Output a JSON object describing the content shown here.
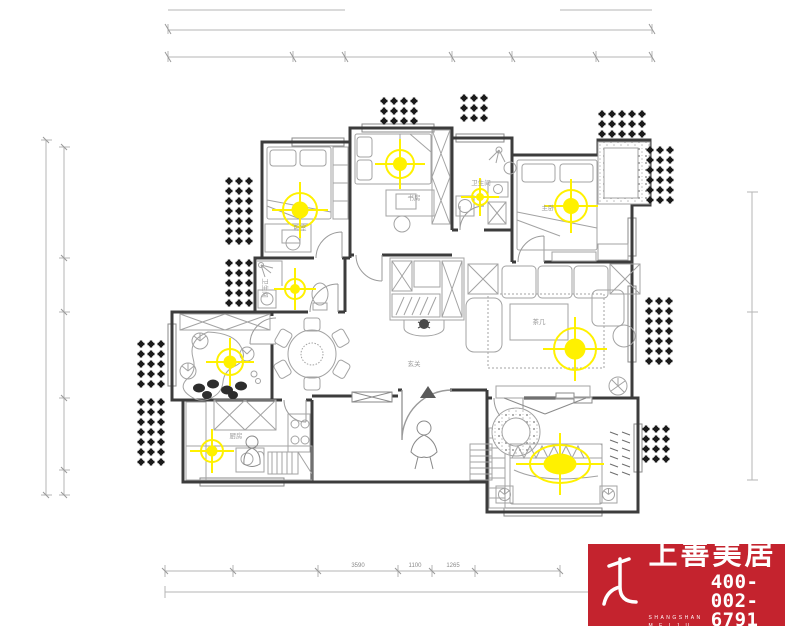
{
  "plan": {
    "wall_color": "#3c3c3c",
    "furniture_color": "#a3a3a3",
    "light_color": "#fff100",
    "plant_color": "#1b1b1b",
    "dimension_color": "#b5b5b5",
    "labels": [
      {
        "text": "卧室",
        "x": 300,
        "y": 230
      },
      {
        "text": "书房",
        "x": 414,
        "y": 200
      },
      {
        "text": "卫生间",
        "x": 481,
        "y": 185
      },
      {
        "text": "主卧",
        "x": 548,
        "y": 210
      },
      {
        "text": "玄关",
        "x": 414,
        "y": 366
      },
      {
        "text": "厨房",
        "x": 236,
        "y": 438
      },
      {
        "text": "茶几",
        "x": 539,
        "y": 324
      },
      {
        "text": "卫生间",
        "x": 263,
        "y": 288,
        "rotate": 90
      }
    ],
    "dimension_labels": [
      {
        "text": "3590",
        "x": 358,
        "y": 567
      },
      {
        "text": "1100",
        "x": 415,
        "y": 567
      },
      {
        "text": "1265",
        "x": 453,
        "y": 567
      }
    ],
    "lights": [
      {
        "x": 300,
        "y": 210,
        "r": 17
      },
      {
        "x": 400,
        "y": 164,
        "r": 14
      },
      {
        "x": 480,
        "y": 197,
        "r": 8
      },
      {
        "x": 571,
        "y": 206,
        "r": 16
      },
      {
        "x": 295,
        "y": 289,
        "r": 10
      },
      {
        "x": 230,
        "y": 362,
        "r": 13
      },
      {
        "x": 575,
        "y": 349,
        "r": 21
      },
      {
        "x": 212,
        "y": 451,
        "r": 11
      },
      {
        "x": 560,
        "y": 464,
        "type": "ellipse",
        "rx": 30,
        "ry": 19
      }
    ],
    "plant_clusters": [
      {
        "x": 384,
        "y": 101,
        "cols": 4,
        "rows": 3
      },
      {
        "x": 464,
        "y": 98,
        "cols": 3,
        "rows": 3
      },
      {
        "x": 602,
        "y": 114,
        "cols": 5,
        "rows": 3
      },
      {
        "x": 650,
        "y": 150,
        "cols": 3,
        "rows": 6
      },
      {
        "x": 229,
        "y": 181,
        "cols": 3,
        "rows": 7
      },
      {
        "x": 229,
        "y": 263,
        "cols": 3,
        "rows": 5
      },
      {
        "x": 141,
        "y": 344,
        "cols": 3,
        "rows": 5
      },
      {
        "x": 141,
        "y": 402,
        "cols": 3,
        "rows": 7
      },
      {
        "x": 649,
        "y": 301,
        "cols": 3,
        "rows": 7
      },
      {
        "x": 646,
        "y": 429,
        "cols": 3,
        "rows": 4
      }
    ]
  },
  "logo": {
    "brand_name": "上善美居",
    "brand_sub_line1": "SHANGSHAN",
    "brand_sub_line2": "M E I J U",
    "phone": "400-002-6791",
    "bg_color": "#c4232e",
    "text_color": "#ffffff"
  }
}
